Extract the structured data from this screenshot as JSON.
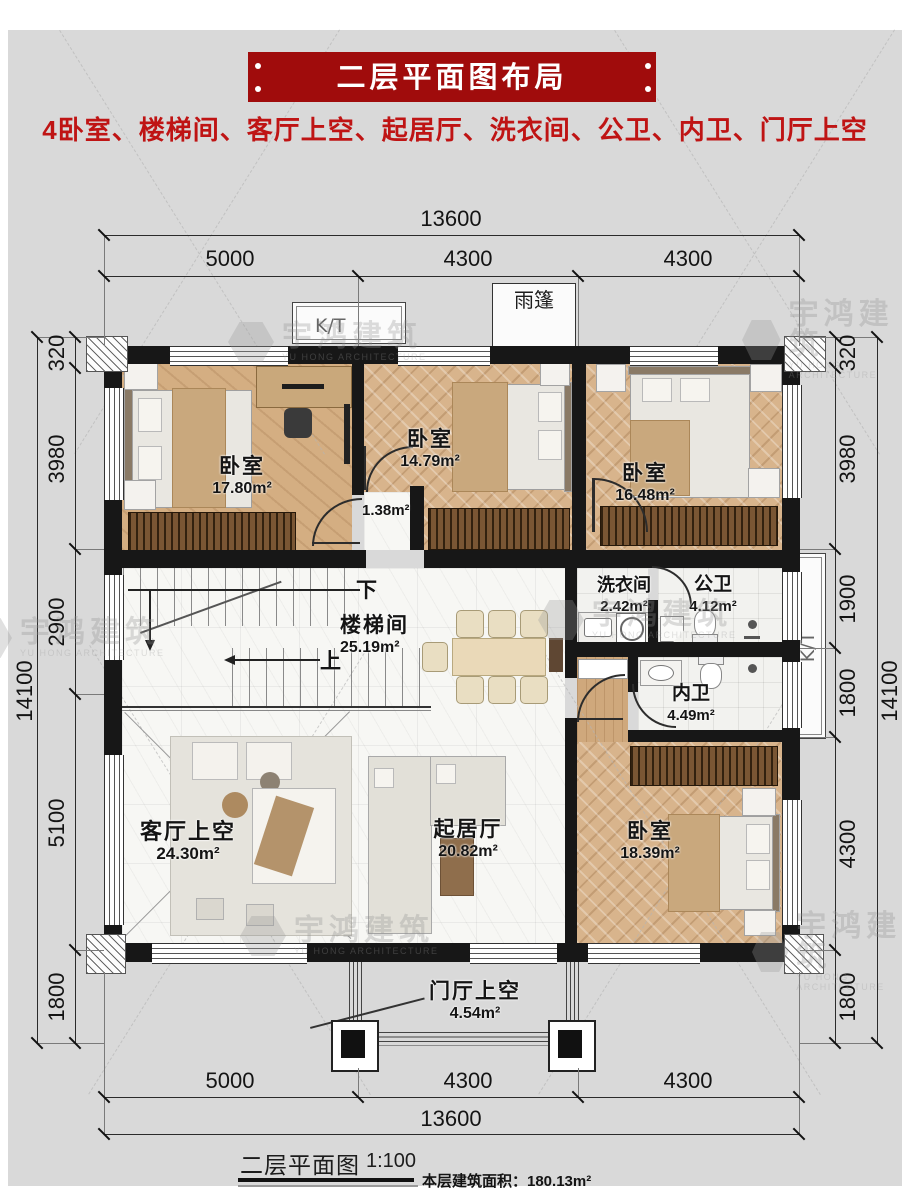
{
  "header": {
    "title": "二层平面图布局",
    "subtitle": "4卧室、楼梯间、客厅上空、起居厅、洗衣间、公卫、内卫、门厅上空"
  },
  "colors": {
    "banner": "#a00c0c",
    "subtitle_text": "#bf1414",
    "wall": "#171717"
  },
  "dims": {
    "top_total": "13600",
    "top_segs": [
      "5000",
      "4300",
      "4300"
    ],
    "bottom_total": "13600",
    "bottom_segs": [
      "5000",
      "4300",
      "4300"
    ],
    "left_total": "14100",
    "left_segs": [
      "320",
      "3980",
      "2900",
      "5100",
      "1800"
    ],
    "right_total": "14100",
    "right_segs": [
      "320",
      "3980",
      "1900",
      "1800",
      "4300",
      "1800"
    ]
  },
  "rooms": {
    "bed1": {
      "name": "卧室",
      "area": "17.80m²"
    },
    "bed2": {
      "name": "卧室",
      "area": "14.79m²"
    },
    "bed3": {
      "name": "卧室",
      "area": "16.48m²"
    },
    "bed4": {
      "name": "卧室",
      "area": "18.39m²"
    },
    "stair": {
      "name": "楼梯间",
      "area": "25.19m²"
    },
    "laundry": {
      "name": "洗衣间",
      "area": "2.42m²"
    },
    "bath_public": {
      "name": "公卫",
      "area": "4.12m²"
    },
    "bath_private": {
      "name": "内卫",
      "area": "4.49m²"
    },
    "living_void": {
      "name": "客厅上空",
      "area": "24.30m²"
    },
    "family": {
      "name": "起居厅",
      "area": "20.82m²"
    },
    "foyer_void": {
      "name": "门厅上空",
      "area": "4.54m²"
    },
    "nook_area": "1.38m²"
  },
  "plan_labels": {
    "canopy": "雨篷",
    "kt": "K/T",
    "down": "下",
    "up": "上"
  },
  "footer": {
    "title": "二层平面图",
    "scale": "1:100",
    "floor_area": "本层建筑面积：180.13m²"
  },
  "watermark": {
    "cn": "宇鸿建筑",
    "en": "YU HONG ARCHITECTURE"
  }
}
